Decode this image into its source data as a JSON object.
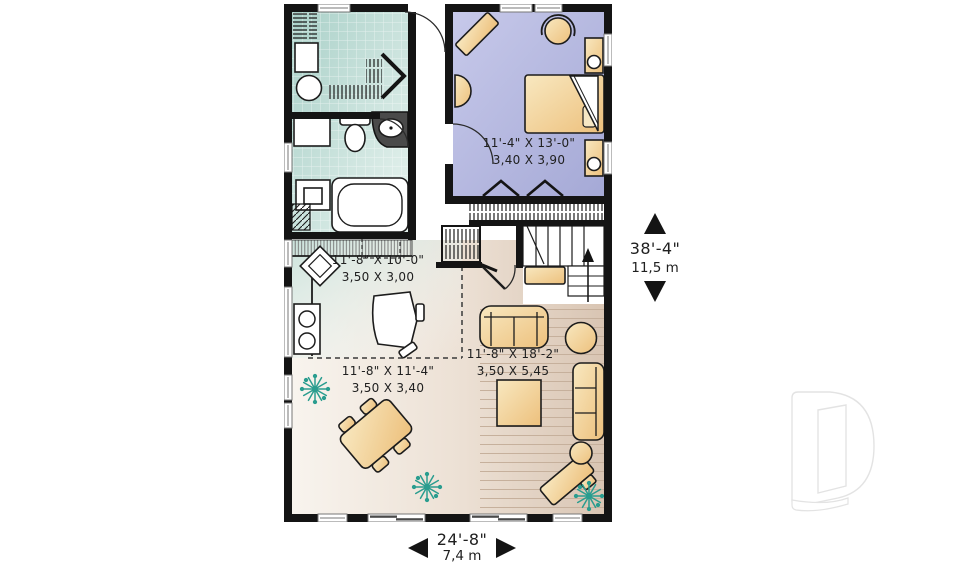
{
  "plan": {
    "rooms": {
      "bedroom": {
        "imperial": "11'-4\" X 13'-0\"",
        "metric": "3,40 X 3,90"
      },
      "kitchen": {
        "imperial": "11'-8\" X 10'-0\"",
        "metric": "3,50 X 3,00"
      },
      "dining": {
        "imperial": "11'-8\" X 11'-4\"",
        "metric": "3,50 X 3,40"
      },
      "living": {
        "imperial": "11'-8\" X 18'-2\"",
        "metric": "3,50 X 5,45"
      }
    },
    "overall": {
      "depth": {
        "imperial": "38'-4\"",
        "metric": "11,5 m"
      },
      "width": {
        "imperial": "24'-8\"",
        "metric": "7,4 m"
      }
    }
  },
  "icons": {
    "up_arrow": "triangle-up",
    "down_arrow": "triangle-down",
    "left_arrow": "triangle-left",
    "right_arrow": "triangle-right",
    "logo": "drummond-d-watermark"
  },
  "colors": {
    "wall": "#141414",
    "text": "#202020",
    "tile_teal": "#b7d8d1",
    "bedroom_lavender": "#b0b3dc",
    "floor_beige": "#e7dacc",
    "furniture_tan": "#f2d29b",
    "plant_teal": "#2a9d8f",
    "logo_gray": "#e3e3e3",
    "page_background": "#ffffff"
  }
}
